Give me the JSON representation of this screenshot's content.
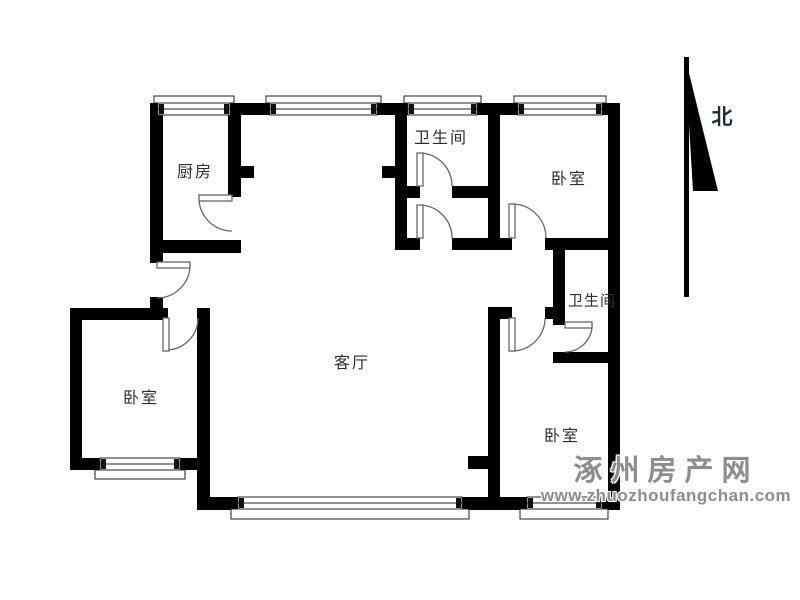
{
  "plan": {
    "rooms": [
      {
        "id": "kitchen",
        "label": "厨房"
      },
      {
        "id": "bathroom-top",
        "label": "卫生间"
      },
      {
        "id": "bedroom-top-right",
        "label": "卧室"
      },
      {
        "id": "living-room",
        "label": "客厅"
      },
      {
        "id": "bathroom-right",
        "label": "卫生间"
      },
      {
        "id": "bedroom-bottom-right",
        "label": "卧室"
      },
      {
        "id": "bedroom-bottom-left",
        "label": "卧室"
      }
    ],
    "compass": {
      "label": "北",
      "direction": "north"
    },
    "watermark": {
      "site_name": "涿州房产网",
      "site_url": "www.zhuozhoufangchan.com"
    },
    "counts": {
      "doors": 8,
      "windows": 7
    },
    "colors": {
      "wall": "#000000",
      "door_line": "#666666",
      "window_line": "#222222",
      "background": "#ffffff",
      "label_text": "#2f2f2f",
      "watermark_text": "#8d8d8d"
    }
  }
}
